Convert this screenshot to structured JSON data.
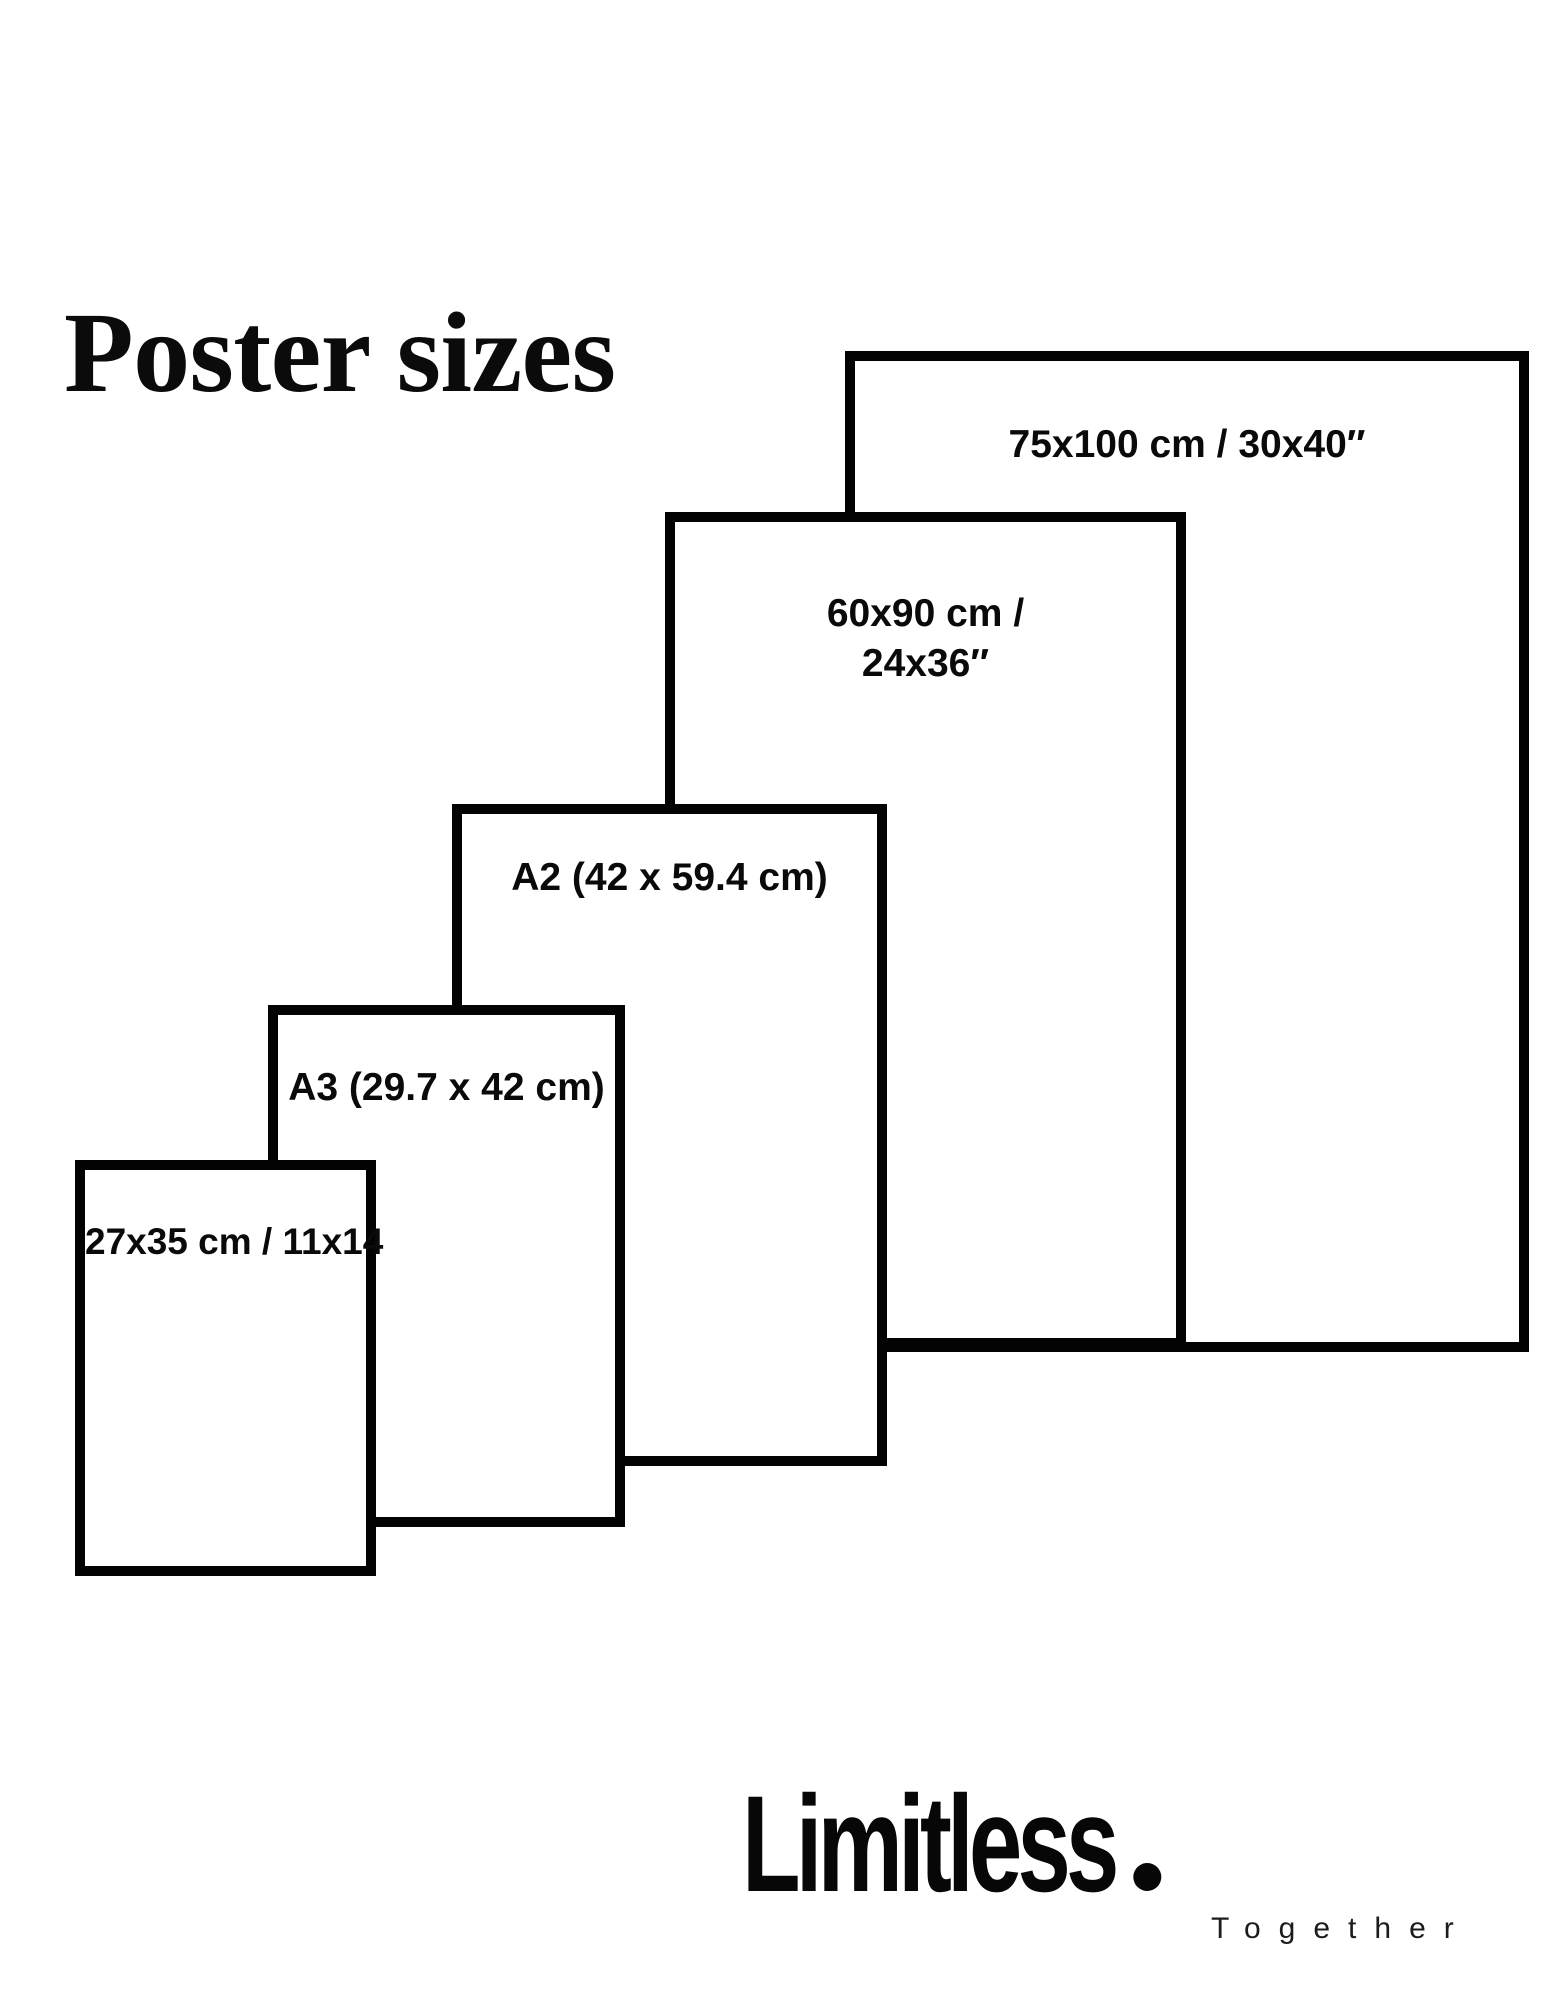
{
  "header": {
    "title": "Poster sizes"
  },
  "posters": {
    "p75": {
      "label": "75x100 cm / 30x40″"
    },
    "p60": {
      "line1": "60x90 cm /",
      "line2": "24x36″"
    },
    "a2": {
      "label": "A2 (42 x 59.4 cm)"
    },
    "a3": {
      "label": "A3 (29.7 x 42 cm)"
    },
    "p27": {
      "label": "27x35 cm / 11x14"
    }
  },
  "brand": {
    "wordmark": "Limitless",
    "period": ".",
    "tagline": "Together"
  },
  "colors": {
    "background": "#ffffff",
    "line": "#030303",
    "text": "#0a0a0a"
  }
}
